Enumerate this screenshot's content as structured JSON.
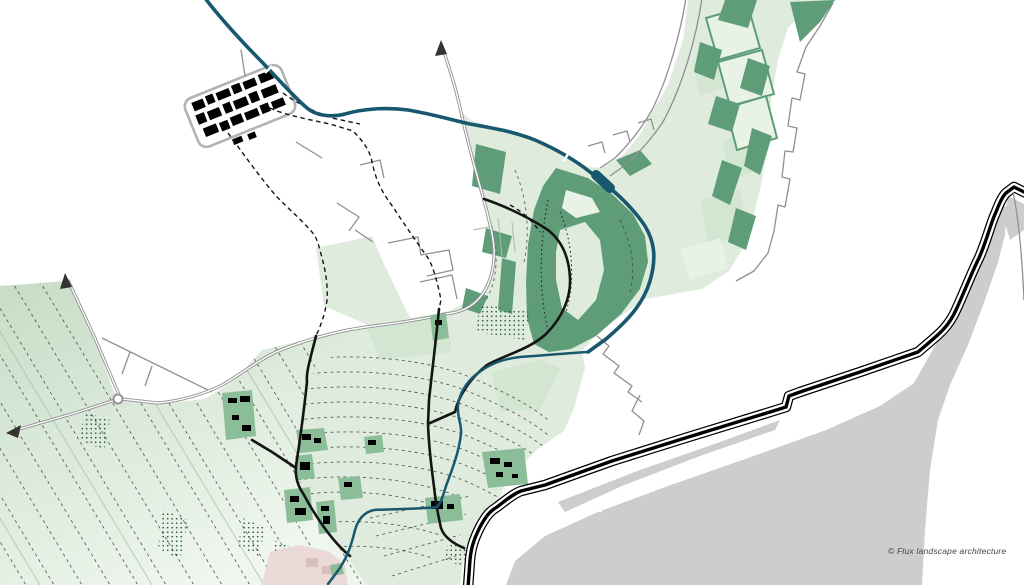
{
  "attribution": "© Flux landscape architecture",
  "map": {
    "title_semantic": "landscape-architecture-masterplan",
    "palette": {
      "background": "#ffffff",
      "polder_light": "#dfecdd",
      "polder_tint": "#d3e6d2",
      "polder_tint2": "#e8f2e6",
      "gradient_start": "#c7ddc6",
      "gradient_end": "#eff6ee",
      "forest": "#5f9d79",
      "yard": "#8cbd99",
      "river": "#17586f",
      "road_gray": "#8f8f8f",
      "parcel_gray": "#a9bba9",
      "road_black": "#141414",
      "parcel_dash": "#3c3c3c",
      "dike": "#000000",
      "water_gray": "#cdcdcd",
      "buildings": "#000000",
      "pink": "#ead9d7",
      "pink_dark": "#d9bfbd",
      "stipple": "#2a5c44",
      "attribution": "#444444"
    },
    "features": [
      "historic-village-block",
      "main-river-canal",
      "stream-network",
      "fortified-town-band",
      "river-bend-park",
      "polder-fields-southwest",
      "central-polder-fields",
      "sea-dike",
      "tidal-flats",
      "country-roads",
      "gray-regional-road",
      "footpaths-dashed",
      "farm-yards",
      "roundabout",
      "road-continuation-arrows"
    ]
  }
}
